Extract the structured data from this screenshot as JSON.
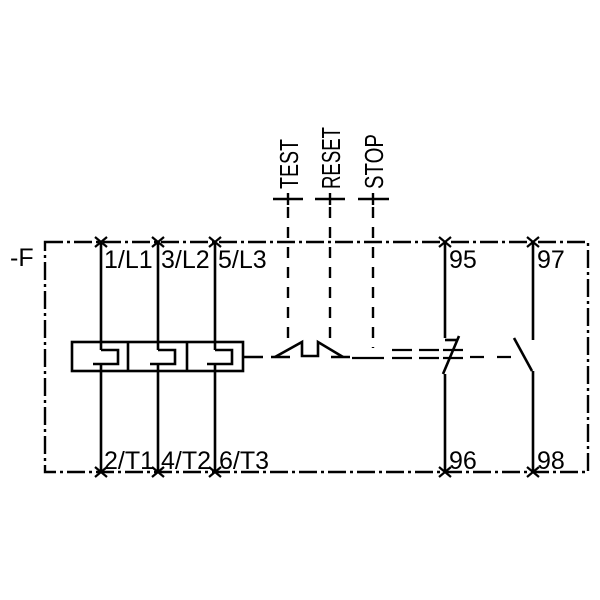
{
  "schematic": {
    "title": "Thermal overload relay circuit diagram",
    "device_designation": "-F",
    "main_terminals": {
      "top": [
        "1/L1",
        "3/L2",
        "5/L3"
      ],
      "bottom": [
        "2/T1",
        "4/T2",
        "6/T3"
      ]
    },
    "aux_terminals": {
      "nc_top": "95",
      "nc_bottom": "96",
      "no_top": "97",
      "no_bottom": "98"
    },
    "actuators": {
      "test": "TEST",
      "reset": "RESET",
      "stop": "STOP"
    },
    "colors": {
      "line": "#000000",
      "background": "#ffffff"
    }
  }
}
